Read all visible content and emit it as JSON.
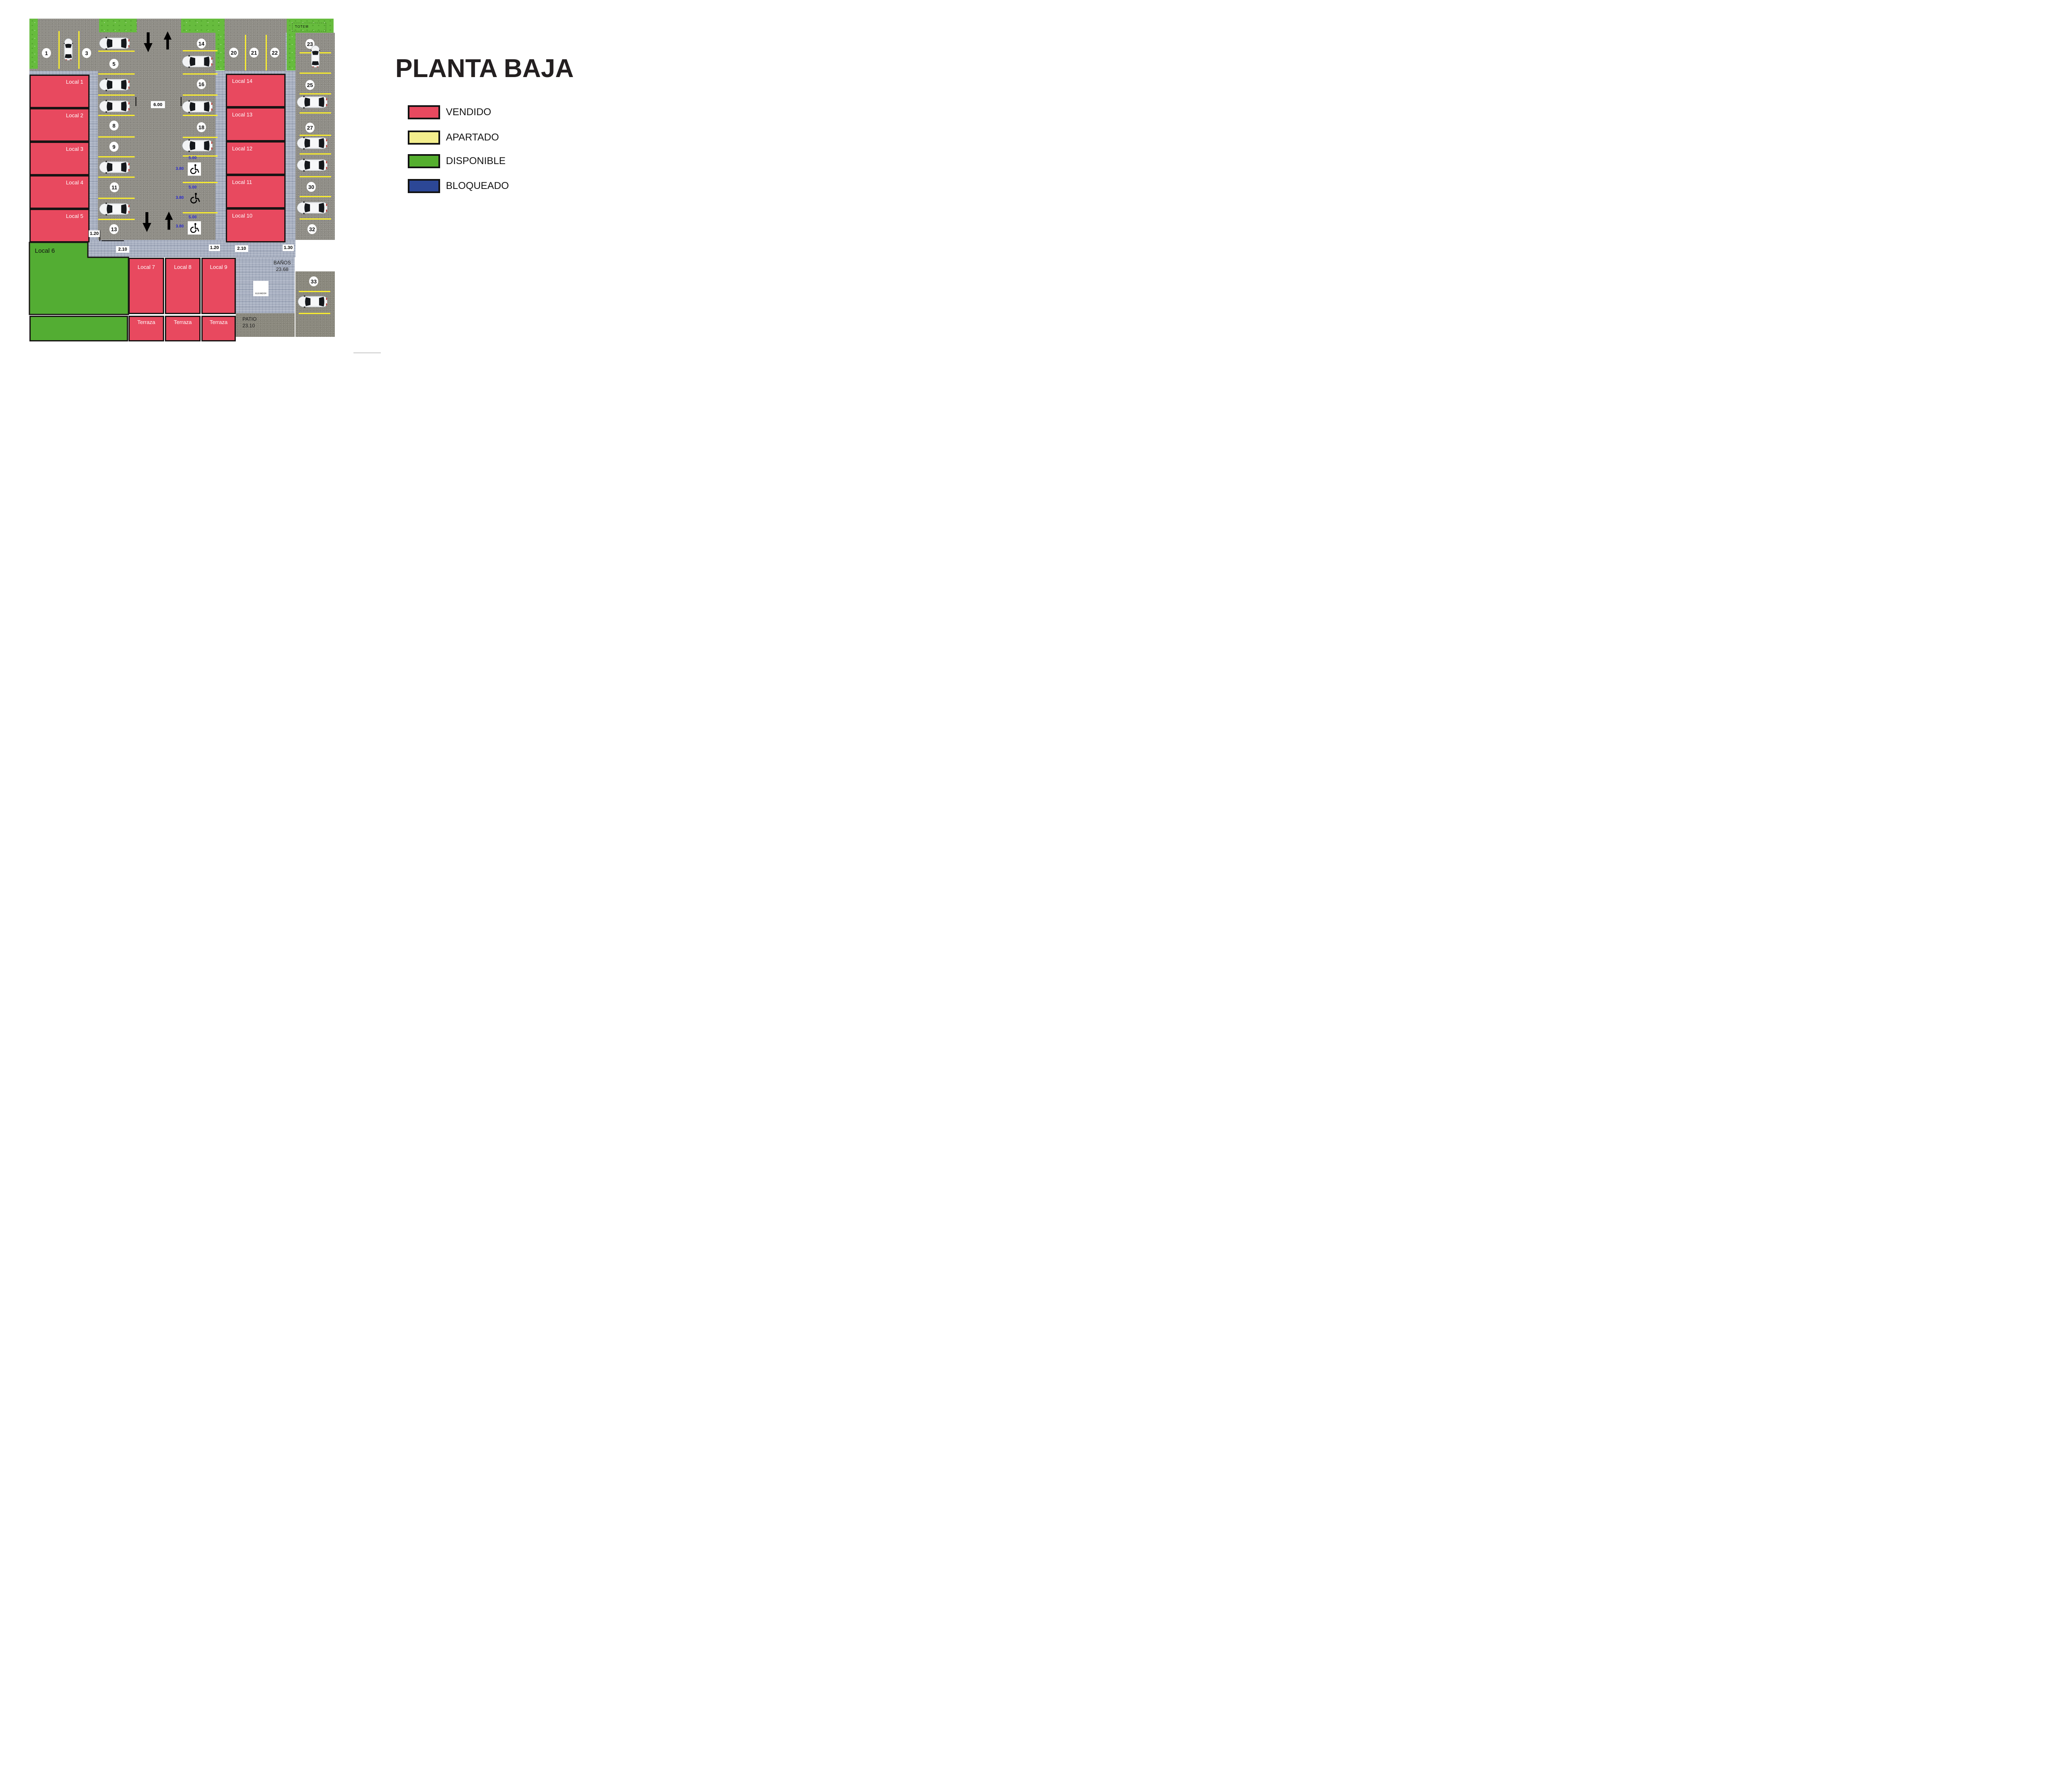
{
  "title": "PLANTA BAJA",
  "legend": {
    "items": [
      {
        "label": "VENDIDO",
        "color": "#e8495f"
      },
      {
        "label": "APARTADO",
        "color": "#f3ee8d"
      },
      {
        "label": "DISPONIBLE",
        "color": "#55ae2f"
      },
      {
        "label": "BLOQUEADO",
        "color": "#2c4796"
      }
    ]
  },
  "plan": {
    "locals": {
      "local1": {
        "label": "Local 1",
        "status": "vendido"
      },
      "local2": {
        "label": "Local 2",
        "status": "vendido"
      },
      "local3": {
        "label": "Local 3",
        "status": "vendido"
      },
      "local4": {
        "label": "Local 4",
        "status": "vendido"
      },
      "local5": {
        "label": "Local 5",
        "status": "vendido"
      },
      "local6": {
        "label": "Local 6",
        "status": "disponible"
      },
      "local7": {
        "label": "Local 7",
        "status": "vendido"
      },
      "local8": {
        "label": "Local 8",
        "status": "vendido"
      },
      "local9": {
        "label": "Local 9",
        "status": "vendido"
      },
      "local10": {
        "label": "Local 10",
        "status": "vendido"
      },
      "local11": {
        "label": "Local 11",
        "status": "vendido"
      },
      "local12": {
        "label": "Local 12",
        "status": "vendido"
      },
      "local13": {
        "label": "Local 13",
        "status": "vendido"
      },
      "local14": {
        "label": "Local 14",
        "status": "vendido"
      },
      "terraza": "Terraza"
    },
    "spots": {
      "n1": "1",
      "n3": "3",
      "n5": "5",
      "n8": "8",
      "n9": "9",
      "n11": "11",
      "n13": "13",
      "n14": "14",
      "n16": "16",
      "n18": "18",
      "n20": "20",
      "n21": "21",
      "n22": "22",
      "n23": "23",
      "n25": "25",
      "n27": "27",
      "n30": "30",
      "n32": "32",
      "n33": "33"
    },
    "dims": {
      "lane_width": "6.00",
      "sidewalk_a": "1.20",
      "sidewalk_b": "2.10",
      "sidewalk_c": "1.30",
      "handicap_length": "5.00",
      "handicap_width": "3.80"
    },
    "areas": {
      "banos_label": "BAÑOS",
      "banos_area": "23.68",
      "patio_label": "PATIO",
      "patio_area": "23.10",
      "elevator_label": "ELEVADOR",
      "totem_label": "TOTEM"
    }
  }
}
